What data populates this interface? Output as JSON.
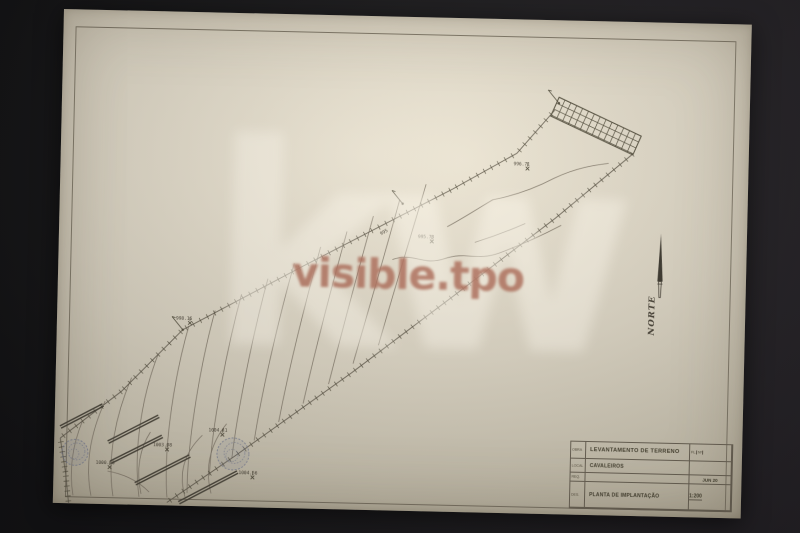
{
  "scene": {
    "description": "Photographed survey drawing sheet on dark background",
    "background_color": "#141416",
    "paper_color": "#ded7c6",
    "line_color": "#6e6759"
  },
  "watermarks": {
    "brand": "kw",
    "overlay_text": "visible.tpo"
  },
  "north_arrow": {
    "label": "NORTE"
  },
  "title_block": {
    "field1_label": "OBRA",
    "field1": "LEVANTAMENTO DE TERRENO",
    "field2_label": "LOCAL",
    "field2": "CAVALEIROS",
    "field3_label": "REQ.",
    "field3": "",
    "field4_label": "DES.",
    "field4": "PLANTA DE IMPLANTAÇÃO",
    "corner_a": "FL.",
    "corner_b": "Nº",
    "date": "JUN 20",
    "scale": "1:200"
  },
  "plan": {
    "spot_elevations": [
      {
        "x": 531,
        "y": 158,
        "label": "996.71"
      },
      {
        "x": 437,
        "y": 233,
        "label": "995.73"
      },
      {
        "x": 197,
        "y": 320,
        "label": "998.16"
      },
      {
        "x": 177,
        "y": 447,
        "label": "1003.98"
      },
      {
        "x": 232,
        "y": 431,
        "label": "1004.41"
      },
      {
        "x": 263,
        "y": 473,
        "label": "1004.56"
      },
      {
        "x": 120,
        "y": 466,
        "label": "1000.16"
      }
    ],
    "contour_labels": [
      {
        "x": 386,
        "y": 228,
        "text": "995",
        "rot": -30
      }
    ],
    "contours": [
      "M430,176 C416,228 400,284 386,338",
      "M404,192 C391,244 375,304 361,357",
      "M378,209 C365,260 350,322 337,378",
      "M352,225 C339,276 323,344 312,398",
      "M326,241 C313,293 297,363 288,417",
      "M300,258 C287,308 271,383 264,436",
      "M274,274 C261,326 247,403 242,454",
      "M248,290 C235,343 221,423 220,472",
      "M222,307 C209,358 197,438 198,490",
      "M196,323 C183,373 173,443 178,495",
      "M166,352 C151,393 143,448 150,495",
      "M140,376 C125,413 117,456 124,495",
      "M114,400 C101,430 95,463 102,495",
      "M92,420 C83,443 79,468 84,495",
      "M452,218 C468,209 484,198 497,190 C520,185 540,177 558,167 C580,156 598,153 612,151",
      "M398,252 C420,244 428,258 450,250 C472,242 482,252 505,243 C530,233 548,224 566,214",
      "M480,233 C498,227 515,220 530,213",
      "M212,432 C196,448 188,468 196,494",
      "M236,420 C222,438 214,462 222,490",
      "M160,430 C150,446 146,468 152,492",
      "M118,470 C132,472 148,478 160,490"
    ],
    "boundaries": {
      "upper": [
        [
          70,
          438
        ],
        [
          130,
          390
        ],
        [
          190,
          327
        ],
        [
          310,
          260
        ],
        [
          457,
          180
        ],
        [
          520,
          143
        ],
        [
          557,
          99
        ]
      ],
      "lower": [
        [
          178,
          500
        ],
        [
          245,
          452
        ],
        [
          360,
          366
        ],
        [
          460,
          287
        ],
        [
          560,
          207
        ],
        [
          636,
          141
        ]
      ],
      "west": [
        [
          70,
          438
        ],
        [
          76,
          472
        ],
        [
          80,
          505
        ]
      ]
    },
    "walls": [
      [
        [
          70,
          427
        ],
        [
          112,
          404
        ]
      ],
      [
        [
          118,
          441
        ],
        [
          168,
          414
        ]
      ],
      [
        [
          121,
          461
        ],
        [
          172,
          434
        ]
      ],
      [
        [
          146,
          482
        ],
        [
          200,
          453
        ]
      ],
      [
        [
          190,
          500
        ],
        [
          248,
          468
        ]
      ]
    ],
    "trees": [
      {
        "x": 85,
        "y": 452,
        "r": 13
      },
      {
        "x": 243,
        "y": 450,
        "r": 16
      }
    ],
    "hatch_area": [
      [
        561,
        86
      ],
      [
        644,
        123
      ],
      [
        636,
        142
      ],
      [
        553,
        105
      ]
    ],
    "markers": [
      {
        "x": 190,
        "y": 327
      },
      {
        "x": 407,
        "y": 196
      },
      {
        "x": 561,
        "y": 92
      }
    ]
  }
}
